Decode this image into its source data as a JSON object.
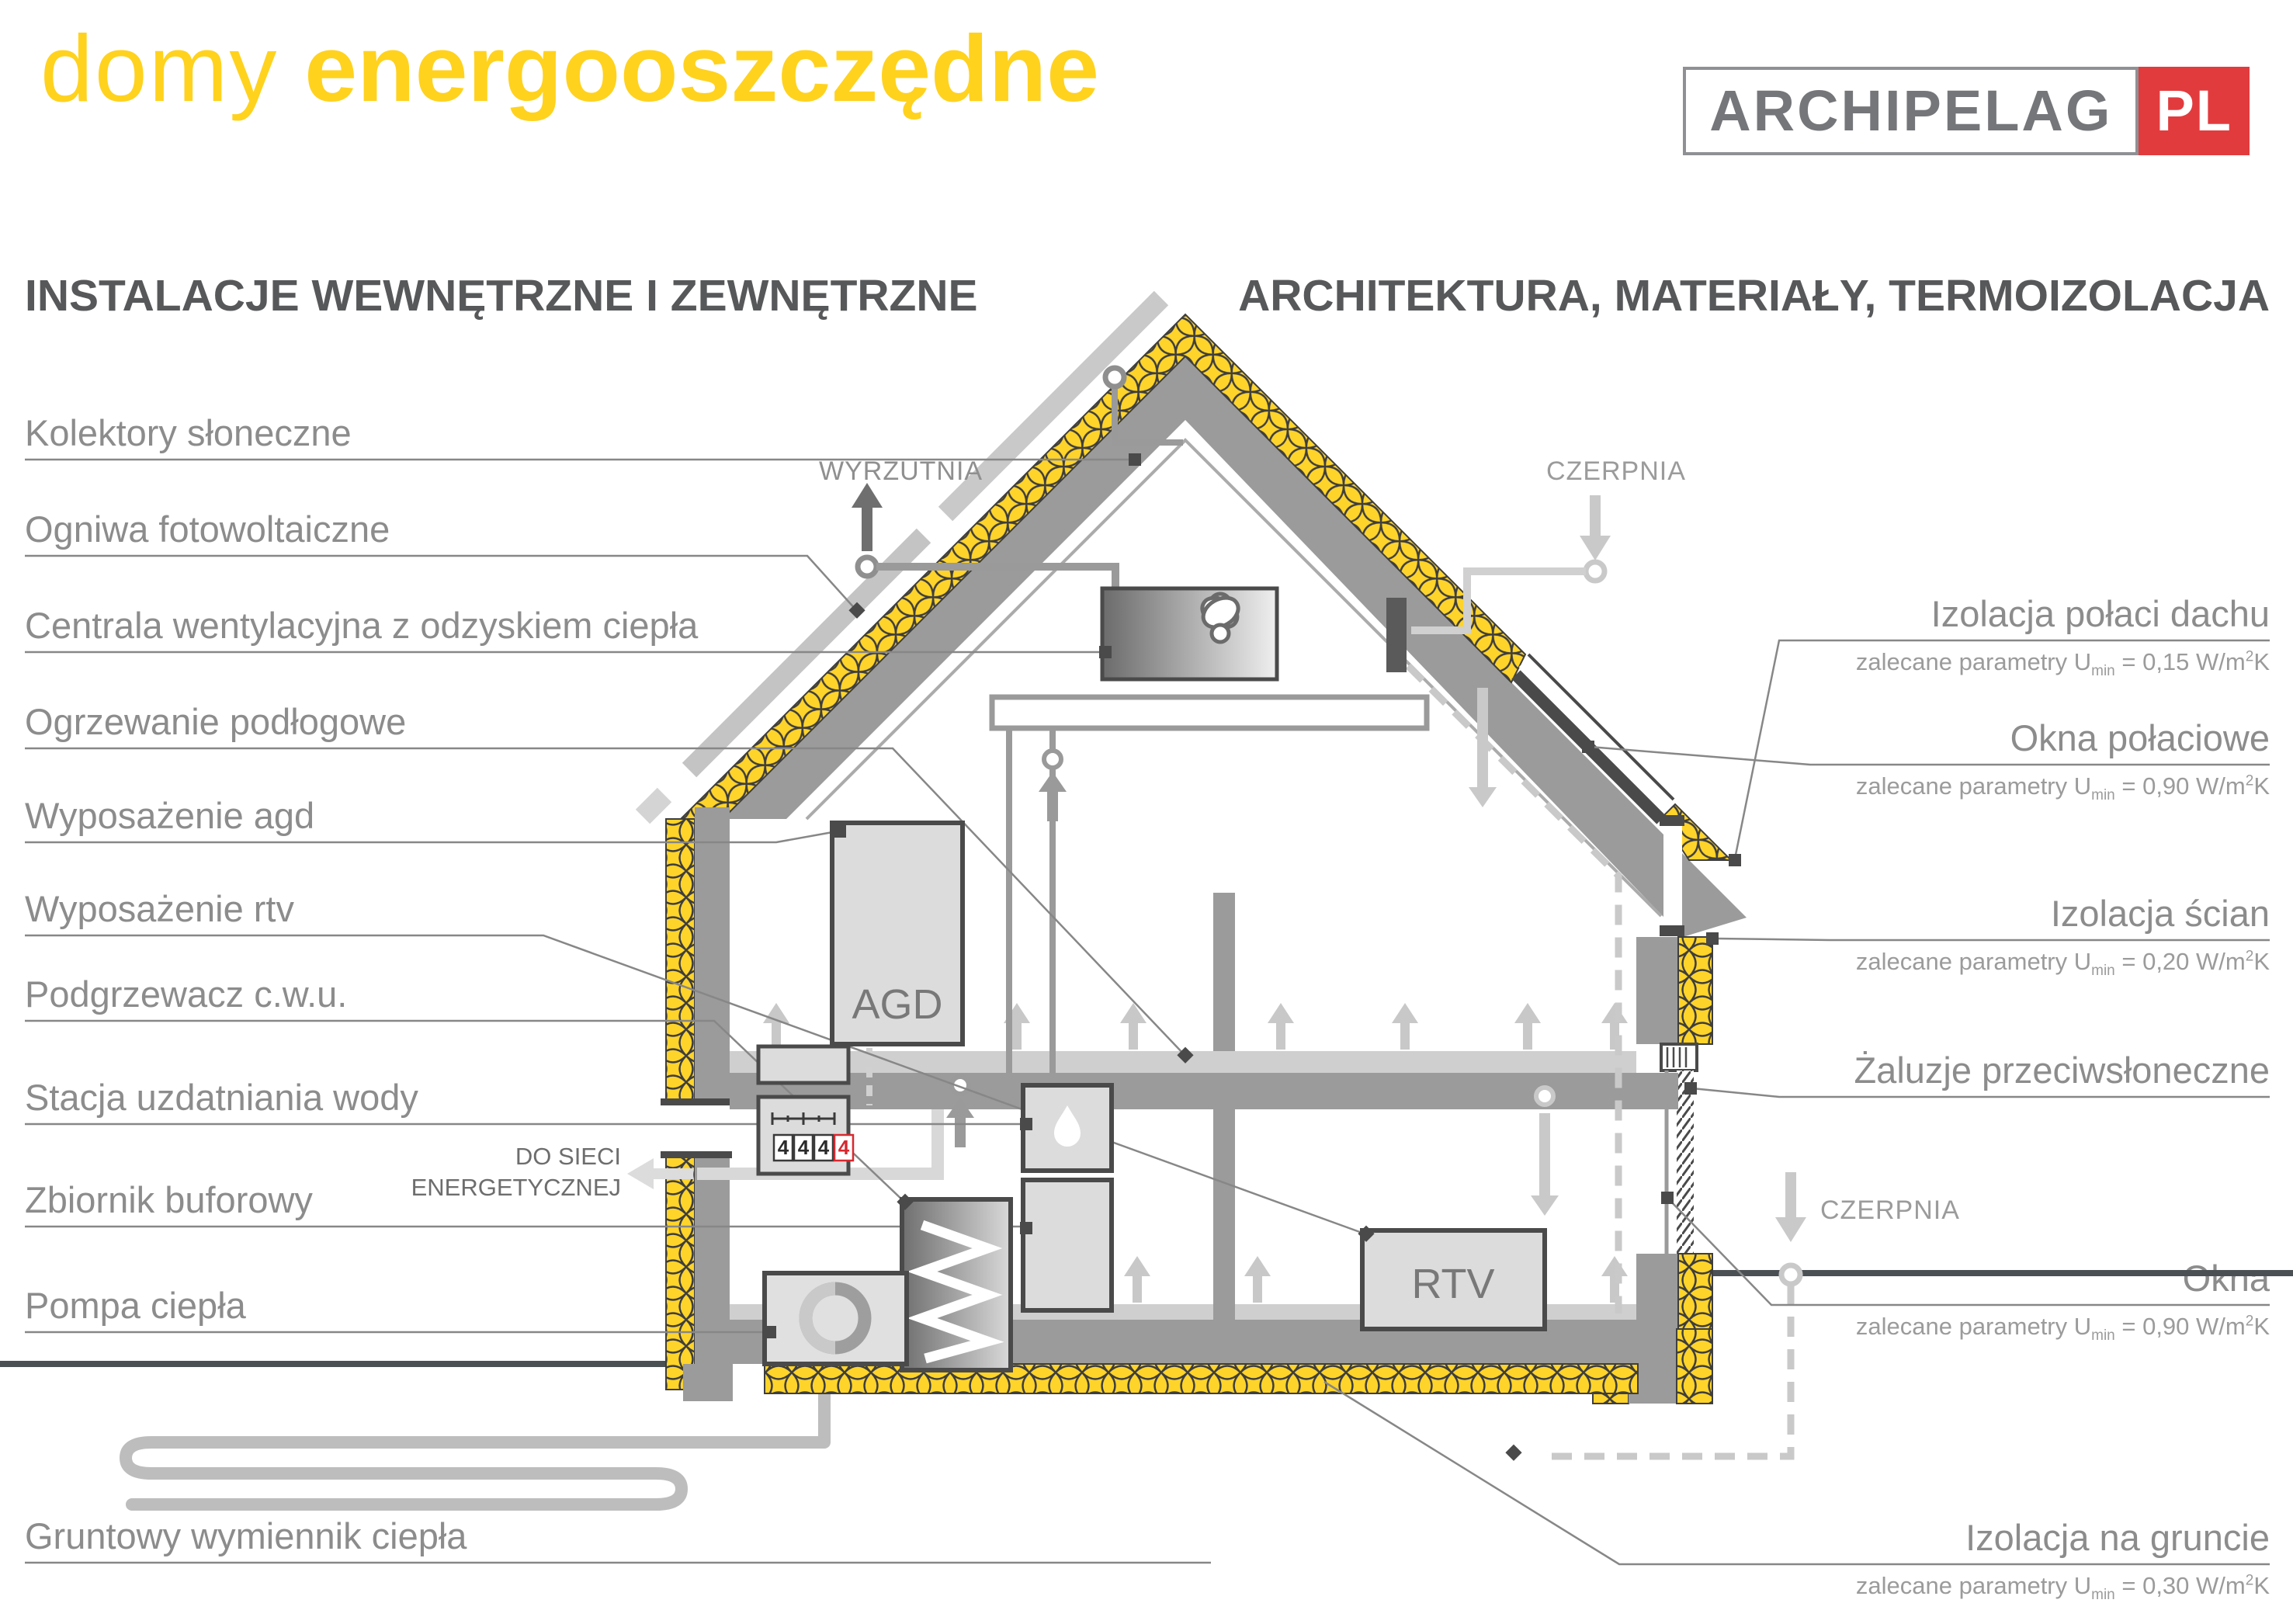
{
  "title": {
    "light": "domy",
    "bold": "energooszczędne"
  },
  "logo": {
    "name": "ARCHIPELAG",
    "tld": "PL"
  },
  "sections": {
    "left": "INSTALACJE WEWNĘTRZNE I ZEWNĘTRZNE",
    "right": "ARCHITEKTURA, MATERIAŁY, TERMOIZOLACJA"
  },
  "labels_left": [
    {
      "text": "Kolektory słoneczne"
    },
    {
      "text": "Ogniwa fotowoltaiczne"
    },
    {
      "text": "Centrala wentylacyjna z odzyskiem ciepła"
    },
    {
      "text": "Ogrzewanie podłogowe"
    },
    {
      "text": "Wyposażenie agd"
    },
    {
      "text": "Wyposażenie rtv"
    },
    {
      "text": "Podgrzewacz c.w.u."
    },
    {
      "text": "Stacja uzdatniania wody"
    },
    {
      "text": "Zbiornik buforowy"
    },
    {
      "text": "Pompa ciepła"
    },
    {
      "text": "Gruntowy wymiennik ciepła"
    }
  ],
  "labels_right": [
    {
      "title": "Izolacja połaci dachu",
      "param": {
        "pre": "zalecane parametry U",
        "sub": "min",
        "mid": " = 0,15 W/m",
        "sup": "2",
        "suf": "K"
      }
    },
    {
      "title": "Okna połaciowe",
      "param": {
        "pre": "zalecane parametry U",
        "sub": "min",
        "mid": " = 0,90 W/m",
        "sup": "2",
        "suf": "K"
      }
    },
    {
      "title": "Izolacja ścian",
      "param": {
        "pre": "zalecane parametry U",
        "sub": "min",
        "mid": " = 0,20 W/m",
        "sup": "2",
        "suf": "K"
      }
    },
    {
      "title": "Żaluzje przeciwsłoneczne"
    },
    {
      "title": "Okna",
      "param": {
        "pre": "zalecane parametry U",
        "sub": "min",
        "mid": " = 0,90 W/m",
        "sup": "2",
        "suf": "K"
      }
    },
    {
      "title": "Izolacja na gruncie",
      "param": {
        "pre": "zalecane parametry U",
        "sub": "min",
        "mid": " = 0,30 W/m",
        "suf": "K",
        "sup": "2"
      }
    }
  ],
  "diagram": {
    "wyrzutnia": "WYRZUTNIA",
    "czerpnia_top": "CZERPNIA",
    "czerpnia_bottom": "CZERPNIA",
    "grid_line1": "DO SIECI",
    "grid_line2": "ENERGETYCZNEJ",
    "agd": "AGD",
    "rtv": "RTV",
    "meter_digits": [
      "4",
      "4",
      "4",
      "4"
    ]
  },
  "colors": {
    "accent_yellow": "#FFD21E",
    "insulation_yellow": "#FFD42A",
    "structure_gray": "#9b9b9b",
    "frame_dark": "#4a4a4a",
    "label_gray": "#8c8c8c",
    "logo_red": "#E23B3E",
    "meter_alert_red": "#D7282F"
  }
}
